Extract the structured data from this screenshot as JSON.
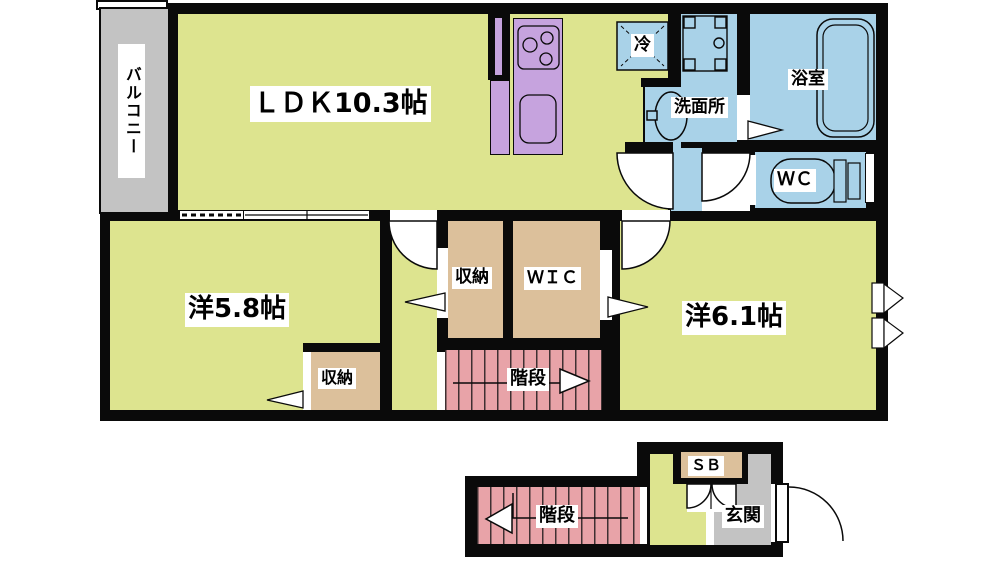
{
  "floor_plan": {
    "type": "japanese-apartment-floor-plan",
    "rooms": {
      "balcony": {
        "label": "バルコニー"
      },
      "ldk": {
        "label": "ＬＤＫ10.3帖"
      },
      "refrigerator": {
        "label": "冷"
      },
      "washroom": {
        "label": "洗面所"
      },
      "bathroom": {
        "label": "浴室"
      },
      "toilet": {
        "label": "ＷＣ"
      },
      "bedroom_5_8": {
        "label": "洋5.8帖"
      },
      "bedroom_closet": {
        "label": "収納"
      },
      "hall_closet": {
        "label": "収納"
      },
      "walk_in_closet": {
        "label": "ＷＩＣ"
      },
      "bedroom_6_1": {
        "label": "洋6.1帖"
      },
      "stairs_upper": {
        "label": "階段"
      },
      "stairs_lower": {
        "label": "階段"
      },
      "shoe_box": {
        "label": "ＳＢ"
      },
      "entrance": {
        "label": "玄関"
      }
    },
    "colors": {
      "room_yellow_green": "#dde48f",
      "water_area_blue": "#a9d2e8",
      "kitchen_purple": "#c6a3de",
      "stairs_pink": "#e8a3a8",
      "storage_tan": "#dcc09b",
      "balcony_entrance_gray": "#c3c3c3",
      "wall_black": "#0a0a0a",
      "label_background": "#ffffff"
    }
  }
}
